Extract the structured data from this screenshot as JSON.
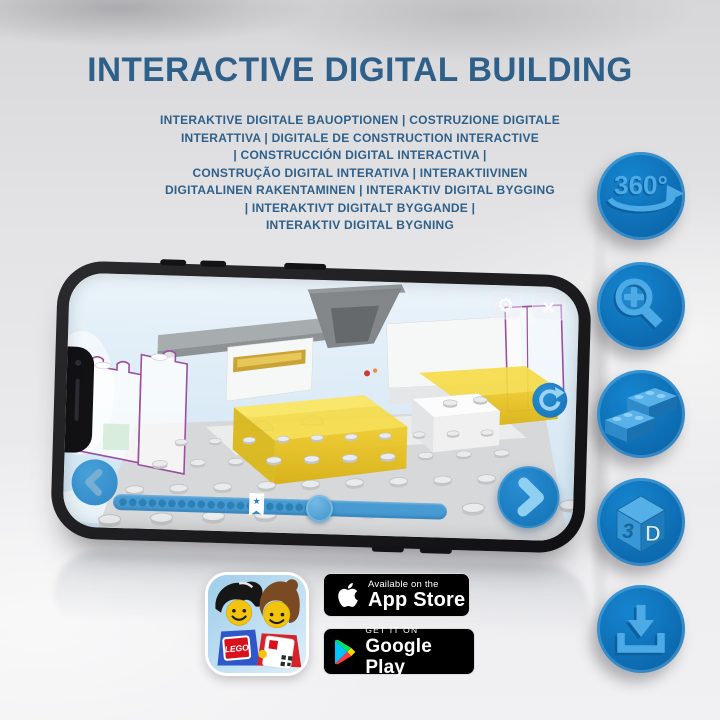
{
  "header": {
    "title": "INTERACTIVE DIGITAL BUILDING",
    "subtitle_lines": [
      "INTERAKTIVE DIGITALE BAUOPTIONEN | COSTRUZIONE DIGITALE",
      "INTERATTIVA | DIGITALE DE CONSTRUCTION INTERACTIVE",
      "| CONSTRUCCIÓN DIGITAL INTERACTIVA |",
      "CONSTRUÇÃO DIGITAL INTERATIVA | INTERAKTIIVINEN",
      "DIGITAALINEN RAKENTAMINEN | INTERAKTIV DIGITAL BYGGING",
      "| INTERAKTIVT DIGITALT BYGGANDE |",
      "INTERAKTIV DIGITAL BYGNING"
    ]
  },
  "feature_icons": {
    "rotation_label": "360°",
    "cube_left_label": "3",
    "cube_right_label": "D"
  },
  "phone_ui": {
    "gear_label": "⚙",
    "close_label": "×",
    "bookmark_star": "★"
  },
  "app_icon": {
    "lego_logo": "LEGO"
  },
  "badges": {
    "app_store": {
      "line1": "Available on the",
      "line2": "App Store"
    },
    "google_play": {
      "line1": "GET IT ON",
      "line2": "Google Play"
    }
  },
  "colors": {
    "heading_blue": "#2f6089",
    "icon_circle_blue": "#0d6bb0",
    "icon_glyph_blue": "#4cabe6",
    "screen_sky": "#dcebf6",
    "brick_yellow": "#f5db48",
    "outline_purple": "#9b4f9e",
    "button_blue": "#1473b8"
  }
}
